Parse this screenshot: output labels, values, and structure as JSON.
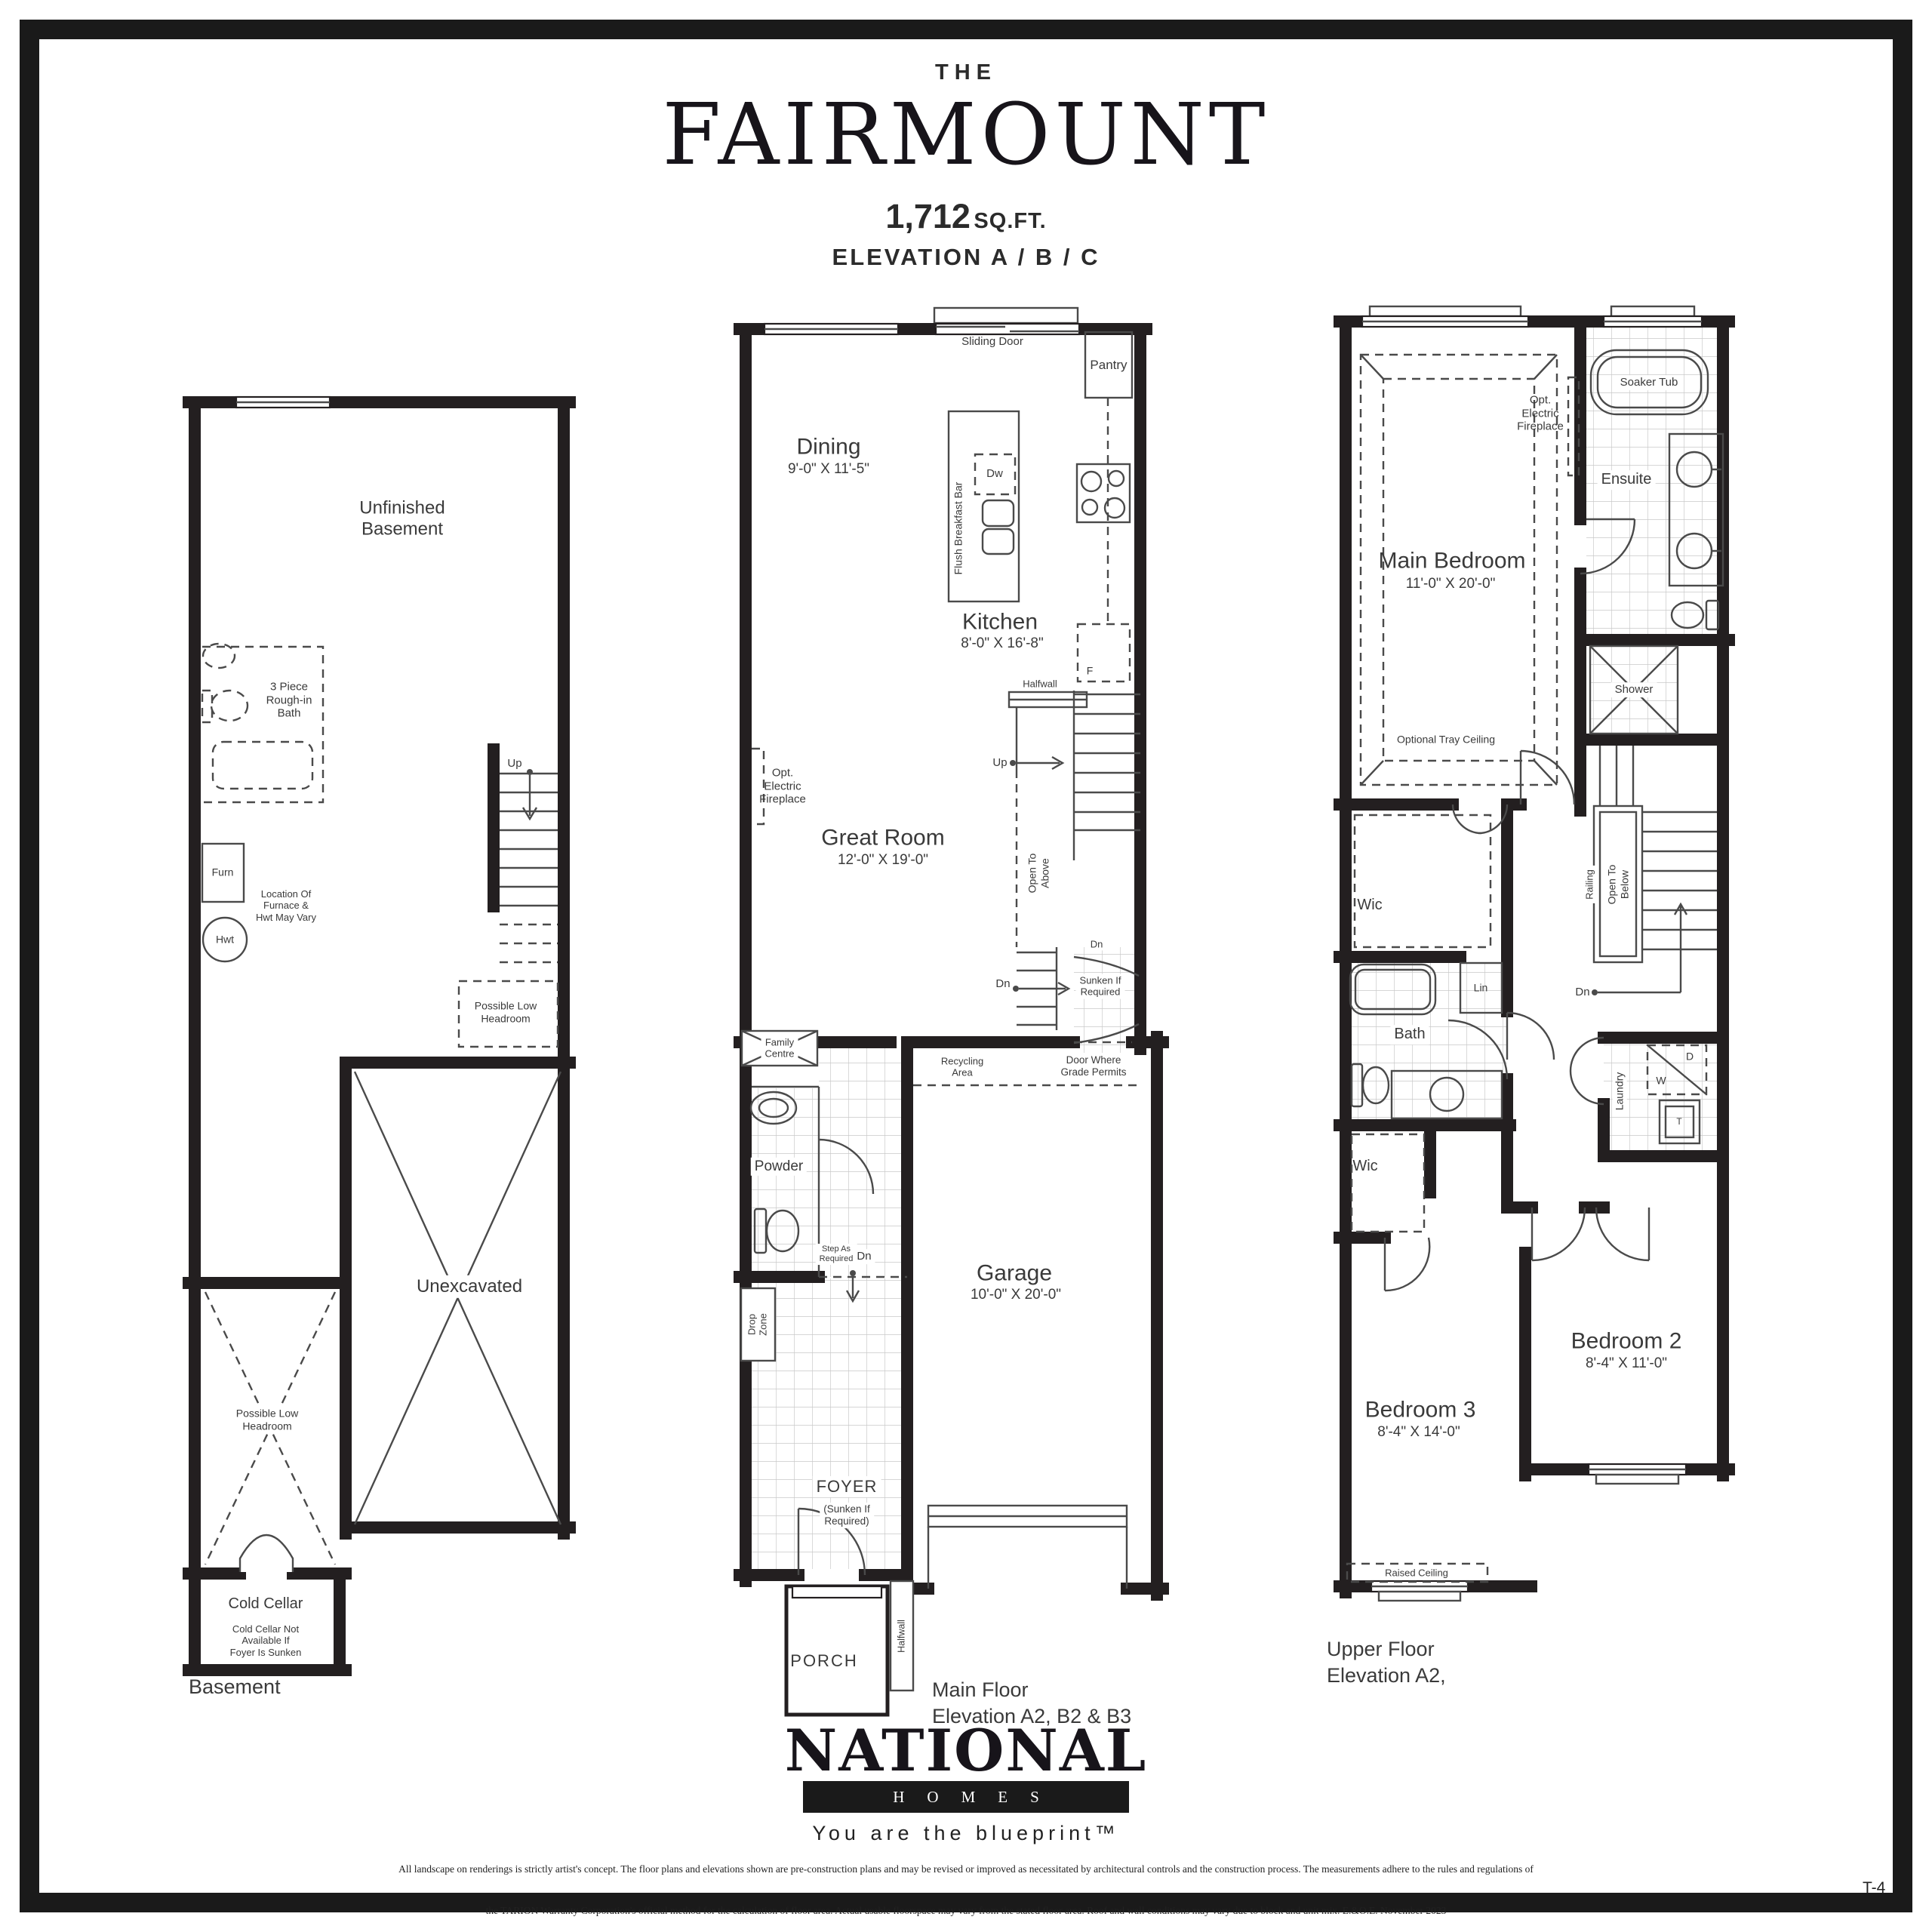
{
  "ink": "#231f20",
  "header": {
    "kicker": "THE",
    "title": "FAIRMOUNT",
    "sqft": "1,712",
    "sqft_unit": "SQ.FT.",
    "elevation": "ELEVATION A / B / C"
  },
  "basement": {
    "caption": "Basement",
    "unfinished": "Unfinished\nBasement",
    "bath": "3 Piece\nRough-in\nBath",
    "up": "Up",
    "furn": "Furn",
    "hwt": "Hwt",
    "furnace_note": "Location Of\nFurnace &\nHwt May Vary",
    "low_headroom_stairs": "Possible Low\nHeadroom",
    "unexcavated": "Unexcavated",
    "low_headroom": "Possible Low\nHeadroom",
    "cold_cellar": "Cold Cellar",
    "cold_cellar_note": "Cold Cellar Not\nAvailable If\nFoyer Is Sunken"
  },
  "main": {
    "caption": "Main Floor\nElevation A2, B2 & B3",
    "sliding_door": "Sliding Door",
    "pantry": "Pantry",
    "dining": "Dining",
    "dining_dims": "9'-0\" X 11'-5\"",
    "breakfast_bar": "Flush Breakfast Bar",
    "dw": "Dw",
    "kitchen": "Kitchen",
    "kitchen_dims": "8'-0\" X 16'-8\"",
    "fridge": "F",
    "halfwall": "Halfwall",
    "fireplace": "Opt.\nElectric\nFireplace",
    "great_room": "Great Room",
    "great_room_dims": "12'-0\" X 19'-0\"",
    "up": "Up",
    "open_above": "Open To\nAbove",
    "dn": "Dn",
    "dn2": "Dn",
    "sunken": "Sunken If\nRequired",
    "family_centre": "Family\nCentre",
    "recycling": "Recycling\nArea",
    "door_grade": "Door Where\nGrade Permits",
    "powder": "Powder",
    "step_required": "Step As\nRequired",
    "dn3": "Dn",
    "drop_zone": "Drop\nZone",
    "garage": "Garage",
    "garage_dims": "10'-0\" X 20'-0\"",
    "foyer": "FOYER",
    "foyer_note": "(Sunken If\nRequired)",
    "porch": "PORCH",
    "halfwall_porch": "Halfwall"
  },
  "upper": {
    "caption": "Upper Floor\nElevation A2,",
    "soaker_tub": "Soaker Tub",
    "fireplace": "Opt.\nElectric\nFireplace",
    "ensuite": "Ensuite",
    "main_bedroom": "Main Bedroom",
    "main_bedroom_dims": "11'-0\" X 20'-0\"",
    "tray_ceiling": "Optional Tray Ceiling",
    "shower": "Shower",
    "wic": "Wic",
    "wic2": "Wic",
    "railing": "Railing",
    "open_below": "Open To\nBelow",
    "dn": "Dn",
    "lin": "Lin",
    "bath": "Bath",
    "laundry": "Laundry",
    "dryer": "D",
    "washer": "W",
    "tub": "T",
    "bedroom2": "Bedroom 2",
    "bedroom2_dims": "8'-4\" X 11'-0\"",
    "bedroom3": "Bedroom 3",
    "bedroom3_dims": "8'-4\" X 14'-0\"",
    "raised_ceiling": "Raised Ceiling"
  },
  "footer": {
    "brand": "NATIONAL",
    "brand_sub": "HOMES",
    "tagline": "You are the blueprint™",
    "disclaimer1": "All landscape on renderings is strictly artist's concept. The floor plans and elevations shown are pre-construction plans and may be revised or improved as necessitated by architectural controls and the construction process. The measurements adhere to the rules and regulations of",
    "disclaimer2": "the TARION Warranty Corporation's official method for the calculation of floor area. Actual usable floorspace may vary from the stated floor area. Roof and wall conditions may vary due to block and unit mix.  E.&O.E. November 2023",
    "page_code": "T-4"
  }
}
